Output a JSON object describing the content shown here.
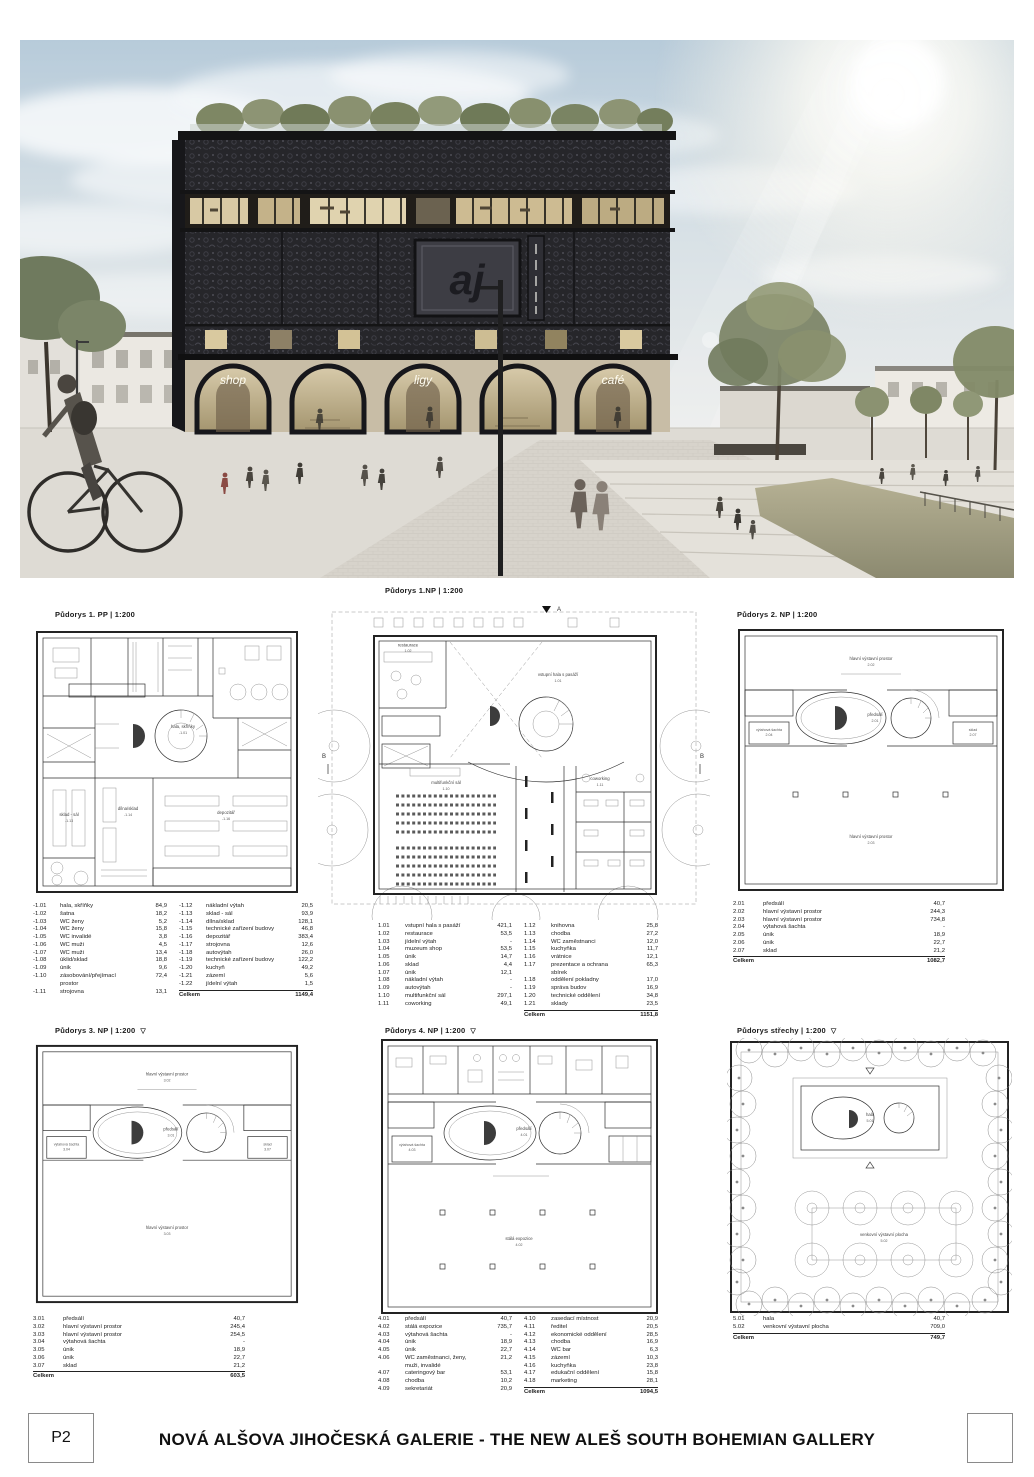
{
  "footer": {
    "sheet_no": "P2",
    "title": "NOVÁ ALŠOVA JIHOČESKÁ GALERIE - THE NEW ALEŠ SOUTH BOHEMIAN GALLERY"
  },
  "rendering": {
    "arch_signs": [
      "shop",
      "ligy",
      "café"
    ],
    "logo_monogram": "aj",
    "colors": {
      "facade": "#26262a",
      "plaza": "#dedbd4",
      "sky": "#b9cdd9",
      "water": "#a8a489"
    }
  },
  "plans": {
    "pp1": {
      "title": "Půdorys 1. PP | 1:200",
      "marker": "",
      "rooms": {
        "hala": "hala, skříňky",
        "hala_code": "-1.01",
        "depozitar": "depozitář",
        "depozitar_code": "-1.16",
        "dilna": "dílna/sklad",
        "dilna_code": "-1.14",
        "sklad_sal": "sklad - sál",
        "sklad_sal_code": "-1.13"
      },
      "legend_cols": [
        {
          "rows": [
            [
              "-1.01",
              "hala, skříňky",
              "84,9"
            ],
            [
              "-1.02",
              "šatna",
              "18,2"
            ],
            [
              "-1.03",
              "WC ženy",
              "5,2"
            ],
            [
              "-1.04",
              "WC ženy",
              "15,8"
            ],
            [
              "-1.05",
              "WC invalidé",
              "3,8"
            ],
            [
              "-1.06",
              "WC muži",
              "4,5"
            ],
            [
              "-1.07",
              "WC muži",
              "13,4"
            ],
            [
              "-1.08",
              "úklid/sklad",
              "18,8"
            ],
            [
              "-1.09",
              "únik",
              "9,6"
            ],
            [
              "-1.10",
              "zásobování/přejímací prostor",
              "72,4"
            ],
            [
              "-1.11",
              "strojovna",
              "13,1"
            ]
          ],
          "total": null
        },
        {
          "rows": [
            [
              "-1.12",
              "nákladní výtah",
              "20,5"
            ],
            [
              "-1.13",
              "sklad - sál",
              "93,9"
            ],
            [
              "-1.14",
              "dílna/sklad",
              "128,1"
            ],
            [
              "-1.15",
              "technické zařízení budovy",
              "46,8"
            ],
            [
              "-1.16",
              "depozitář",
              "383,4"
            ],
            [
              "-1.17",
              "strojovna",
              "12,6"
            ],
            [
              "-1.18",
              "autovýtah",
              "26,0"
            ],
            [
              "-1.19",
              "technické zařízení budovy",
              "122,2"
            ],
            [
              "-1.20",
              "kuchyň",
              "49,2"
            ],
            [
              "-1.21",
              "zázemí",
              "5,6"
            ],
            [
              "-1.22",
              "jídelní výtah",
              "1,5"
            ]
          ],
          "total": [
            "Celkem",
            "1149,4"
          ]
        }
      ]
    },
    "np1": {
      "title": "Půdorys 1.NP | 1:200",
      "marker": "",
      "section_a": "A",
      "section_b": "B",
      "rooms": {
        "hala": "vstupní hala s pasáží",
        "hala_code": "1.01",
        "sal": "multifunkční sál",
        "sal_code": "1.10",
        "restaurace": "restaurace",
        "restaurace_code": "1.02",
        "coworking": "coworking",
        "coworking_code": "1.11"
      },
      "legend_cols": [
        {
          "rows": [
            [
              "1.01",
              "vstupní hala s pasáží",
              "421,1"
            ],
            [
              "1.02",
              "restaurace",
              "53,5"
            ],
            [
              "1.03",
              "jídelní výtah",
              "-"
            ],
            [
              "1.04",
              "muzeum shop",
              "53,5"
            ],
            [
              "1.05",
              "únik",
              "14,7"
            ],
            [
              "1.06",
              "sklad",
              "4,4"
            ],
            [
              "1.07",
              "únik",
              "12,1"
            ],
            [
              "1.08",
              "nákladní výtah",
              "-"
            ],
            [
              "1.09",
              "autovýtah",
              "-"
            ],
            [
              "1.10",
              "multifunkční sál",
              "297,1"
            ],
            [
              "1.11",
              "coworking",
              "49,1"
            ]
          ],
          "total": null
        },
        {
          "rows": [
            [
              "1.12",
              "knihovna",
              "25,8"
            ],
            [
              "1.13",
              "chodba",
              "27,2"
            ],
            [
              "1.14",
              "WC zaměstnanci",
              "12,0"
            ],
            [
              "1.15",
              "kuchyňka",
              "11,7"
            ],
            [
              "1.16",
              "vrátnice",
              "12,1"
            ],
            [
              "1.17",
              "prezentace a ochrana sbírek",
              "65,3"
            ],
            [
              "1.18",
              "oddělení pokladny",
              "17,0"
            ],
            [
              "1.19",
              "správa budov",
              "16,9"
            ],
            [
              "1.20",
              "technické oddělení",
              "34,8"
            ],
            [
              "1.21",
              "sklady",
              "23,5"
            ]
          ],
          "total": [
            "Celkem",
            "1151,8"
          ]
        }
      ]
    },
    "np2": {
      "title": "Půdorys 2. NP | 1:200",
      "marker": "",
      "rooms": {
        "top": "hlavní výstavní prostor",
        "top_code": "2.02",
        "center": "předsálí",
        "center_code": "2.01",
        "bottom": "hlavní výstavní prostor",
        "bottom_code": "2.03",
        "sachta": "výtahová šachta",
        "sachta_code": "2.04",
        "sklad": "sklad",
        "sklad_code": "2.07"
      },
      "legend_cols": [
        {
          "rows": [
            [
              "2.01",
              "předsálí",
              "40,7"
            ],
            [
              "2.02",
              "hlavní výstavní prostor",
              "244,3"
            ],
            [
              "2.03",
              "hlavní výstavní prostor",
              "734,8"
            ],
            [
              "2.04",
              "výtahová šachta",
              "-"
            ],
            [
              "2.05",
              "únik",
              "18,9"
            ],
            [
              "2.06",
              "únik",
              "22,7"
            ],
            [
              "2.07",
              "sklad",
              "21,2"
            ]
          ],
          "total": [
            "Celkem",
            "1082,7"
          ]
        }
      ]
    },
    "np3": {
      "title": "Půdorys 3. NP | 1:200",
      "marker": "▽",
      "rooms": {
        "top": "hlavní výstavní prostor",
        "top_code": "3.02",
        "center": "předsálí",
        "center_code": "3.01",
        "bottom": "hlavní výstavní prostor",
        "bottom_code": "3.03",
        "sachta": "výtahová šachta",
        "sachta_code": "3.04",
        "sklad": "sklad",
        "sklad_code": "3.07"
      },
      "legend_cols": [
        {
          "rows": [
            [
              "3.01",
              "předsálí",
              "40,7"
            ],
            [
              "3.02",
              "hlavní výstavní prostor",
              "245,4"
            ],
            [
              "3.03",
              "hlavní výstavní prostor",
              "254,5"
            ],
            [
              "3.04",
              "výtahová šachta",
              "-"
            ],
            [
              "3.05",
              "únik",
              "18,9"
            ],
            [
              "3.06",
              "únik",
              "22,7"
            ],
            [
              "3.07",
              "sklad",
              "21,2"
            ]
          ],
          "total": [
            "Celkem",
            "603,5"
          ]
        }
      ]
    },
    "np4": {
      "title": "Půdorys 4. NP | 1:200",
      "marker": "▽",
      "rooms": {
        "center": "předsálí",
        "center_code": "4.01",
        "bottom": "stálá expozice",
        "bottom_code": "4.02",
        "sachta": "výtahová šachta",
        "sachta_code": "4.03"
      },
      "legend_cols": [
        {
          "rows": [
            [
              "4.01",
              "předsálí",
              "40,7"
            ],
            [
              "4.02",
              "stálá expozice",
              "735,7"
            ],
            [
              "4.03",
              "výtahová šachta",
              "-"
            ],
            [
              "4.04",
              "únik",
              "18,9"
            ],
            [
              "4.05",
              "únik",
              "22,7"
            ],
            [
              "4.06",
              "WC zaměstnanci, ženy, muži, invalidé",
              "21,2"
            ],
            [
              "4.07",
              "cateringový bar",
              "53,1"
            ],
            [
              "4.08",
              "chodba",
              "10,2"
            ],
            [
              "4.09",
              "sekretariát",
              "20,9"
            ]
          ],
          "total": null
        },
        {
          "rows": [
            [
              "4.10",
              "zasedací místnost",
              "20,9"
            ],
            [
              "4.11",
              "ředitel",
              "20,5"
            ],
            [
              "4.12",
              "ekonomické oddělení",
              "28,5"
            ],
            [
              "4.13",
              "chodba",
              "16,9"
            ],
            [
              "4.14",
              "WC bar",
              "6,3"
            ],
            [
              "4.15",
              "zázemí",
              "10,3"
            ],
            [
              "4.16",
              "kuchyňka",
              "23,8"
            ],
            [
              "4.17",
              "edukační oddělení",
              "15,8"
            ],
            [
              "4.18",
              "marketing",
              "28,1"
            ]
          ],
          "total": [
            "Celkem",
            "1094,5"
          ]
        }
      ]
    },
    "roof": {
      "title": "Půdorys střechy | 1:200",
      "marker": "▽",
      "rooms": {
        "hala": "hala",
        "hala_code": "5.01",
        "plocha": "venkovní výstavní plocha",
        "plocha_code": "5.02"
      },
      "legend_cols": [
        {
          "rows": [
            [
              "5.01",
              "hala",
              "40,7"
            ],
            [
              "5.02",
              "venkovní výstavní plocha",
              "709,0"
            ]
          ],
          "total": [
            "Celkem",
            "749,7"
          ]
        }
      ]
    }
  }
}
